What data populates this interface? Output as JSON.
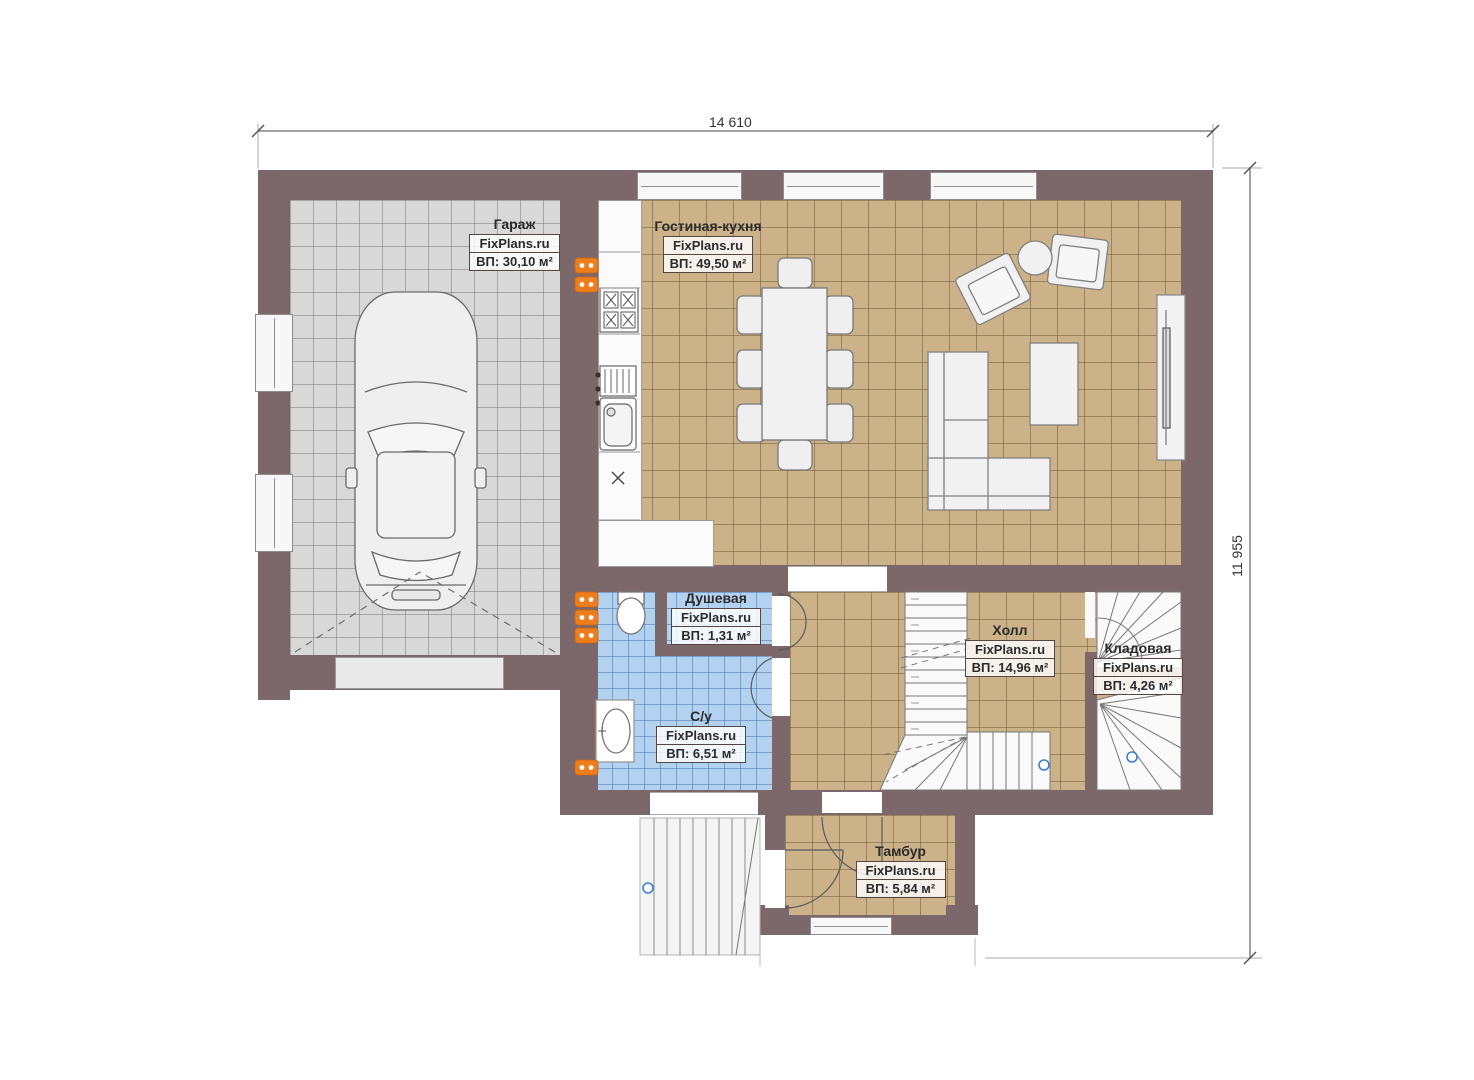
{
  "plan": {
    "dimensions": {
      "top": "14 610",
      "right": "11 955"
    },
    "rooms": {
      "garage": {
        "name": "Гараж",
        "watermark": "FixPlans.ru",
        "area": "ВП: 30,10 м²"
      },
      "living_kitchen": {
        "name": "Гостиная-кухня",
        "watermark": "FixPlans.ru",
        "area": "ВП: 49,50 м²"
      },
      "shower": {
        "name": "Душевая",
        "watermark": "FixPlans.ru",
        "area": "ВП: 1,31 м²"
      },
      "wc": {
        "name": "С/у",
        "watermark": "FixPlans.ru",
        "area": "ВП: 6,51 м²"
      },
      "hall": {
        "name": "Холл",
        "watermark": "FixPlans.ru",
        "area": "ВП: 14,96 м²"
      },
      "storage": {
        "name": "Кладовая",
        "watermark": "FixPlans.ru",
        "area": "ВП: 4,26 м²"
      },
      "vestibule": {
        "name": "Тамбур",
        "watermark": "FixPlans.ru",
        "area": "ВП: 5,84 м²"
      }
    },
    "colors": {
      "wall": "#7c686a",
      "garage_floor": "#d8d8d8",
      "living_floor": "#cbb289",
      "wet_floor": "#b3d2ef",
      "radiator": "#ee7d1e"
    }
  }
}
